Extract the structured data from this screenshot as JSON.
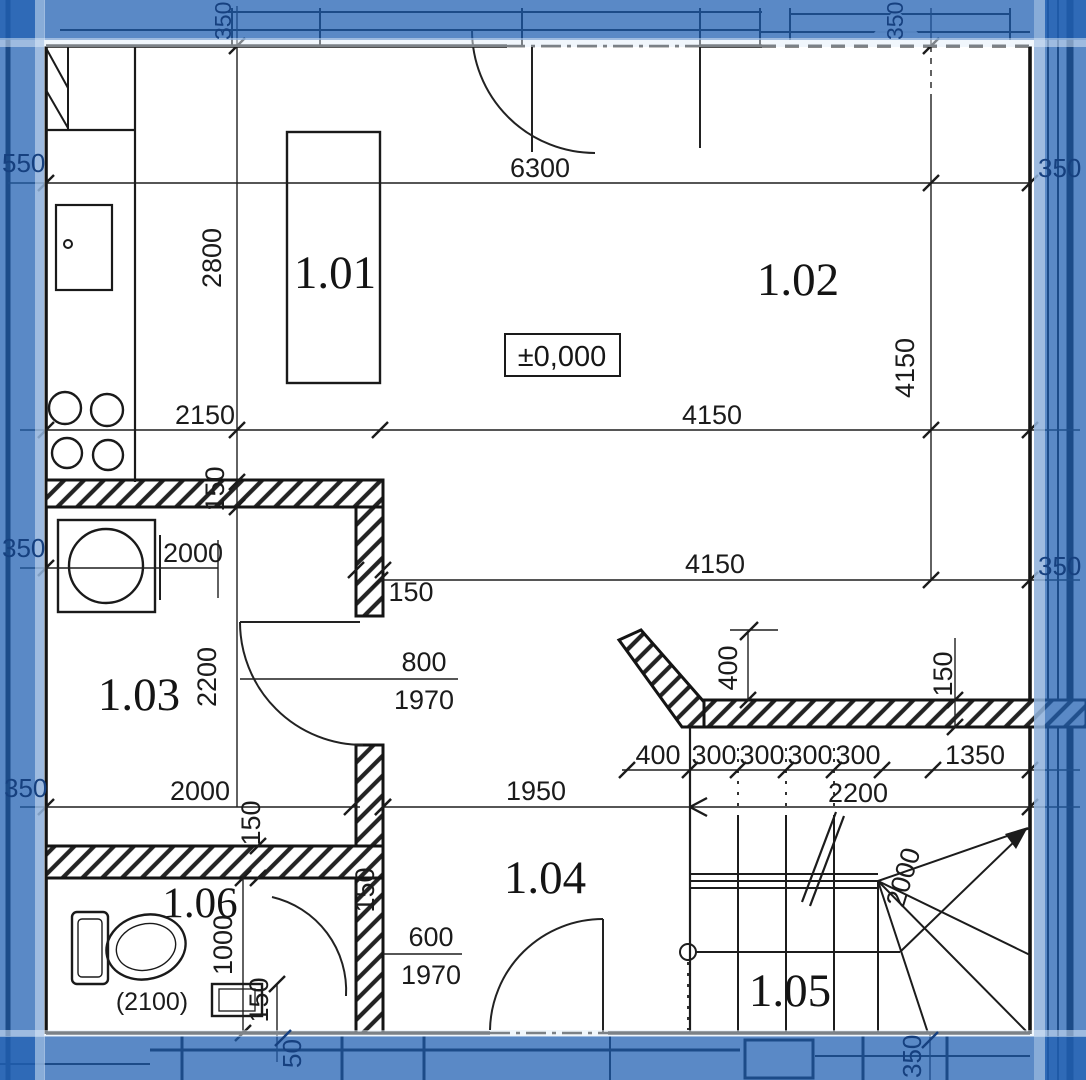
{
  "rooms": {
    "r101": "1.01",
    "r102": "1.02",
    "r103": "1.03",
    "r104": "1.04",
    "r105": "1.05",
    "r106": "1.06"
  },
  "level": {
    "zero": "±0,000"
  },
  "dims": {
    "top_total": "6300",
    "upper_left_height": "2800",
    "kitchen_width": "2150",
    "living_width_upper": "4150",
    "living_width_lower": "4150",
    "living_height_right": "4150",
    "washer_offset": "2000",
    "room103_bottom_width": "2000",
    "stair_diag": "2000",
    "room103_height": "2200",
    "stair_run": "2200",
    "hall_width": "1950",
    "stair_top_offset": "400",
    "tread_first": "400",
    "tread_2": "300",
    "tread_3": "300",
    "tread_4": "300",
    "tread_5": "300",
    "stair_right_width": "1350",
    "wc_width": "1000",
    "wc_note": "(2100)",
    "door103_width": "800",
    "door103_height": "1970",
    "door104_width": "600",
    "door104_height": "1970",
    "wall_150_a": "150",
    "wall_150_b": "150",
    "wall_150_c": "150",
    "wall_150_d": "150",
    "wall_150_e": "150",
    "wall_150_f": "150"
  },
  "edges": {
    "left_top": "550",
    "left_mid": "350",
    "left_bottom": "350",
    "top_left": "350",
    "top_right": "350",
    "right_top": "350",
    "right_mid": "350",
    "right_bottom": "350",
    "bottom_right": "350",
    "bottom_left": "50"
  }
}
